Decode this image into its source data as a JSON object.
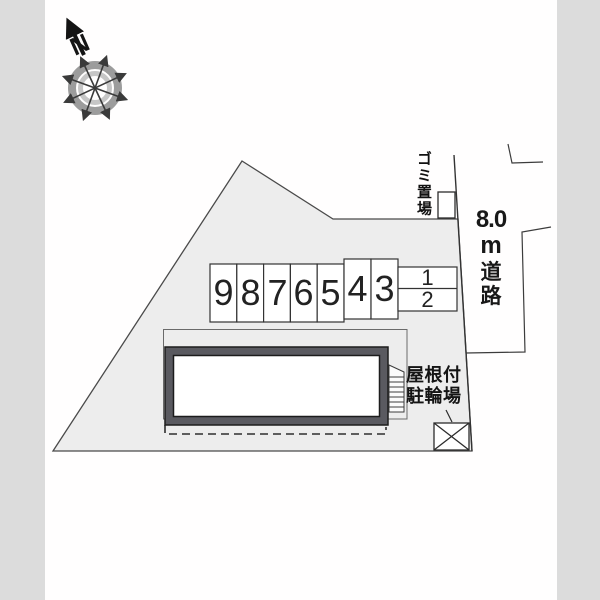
{
  "diagram_type": "property-site-plan",
  "colors": {
    "page_background": "#fffefe",
    "margin_band": "#dcdcdc",
    "site_fill": "#ededed",
    "line": "#3f3f3f",
    "building_frame": "#5a5a60",
    "compass_outer_ring": "#9c9c9c",
    "compass_inner_ring": "#c6c6c6"
  },
  "compass": {
    "north_label": "N"
  },
  "parking": {
    "spaces": [
      "9",
      "8",
      "7",
      "6",
      "5",
      "4",
      "3",
      "1",
      "2"
    ]
  },
  "labels": {
    "garbage_area": "ゴミ置場",
    "road": "8.0m道路",
    "road_parts": [
      "8.0",
      "m",
      "道",
      "路"
    ],
    "bike_shed_line1": "屋根付",
    "bike_shed_line2": "駐輪場"
  }
}
